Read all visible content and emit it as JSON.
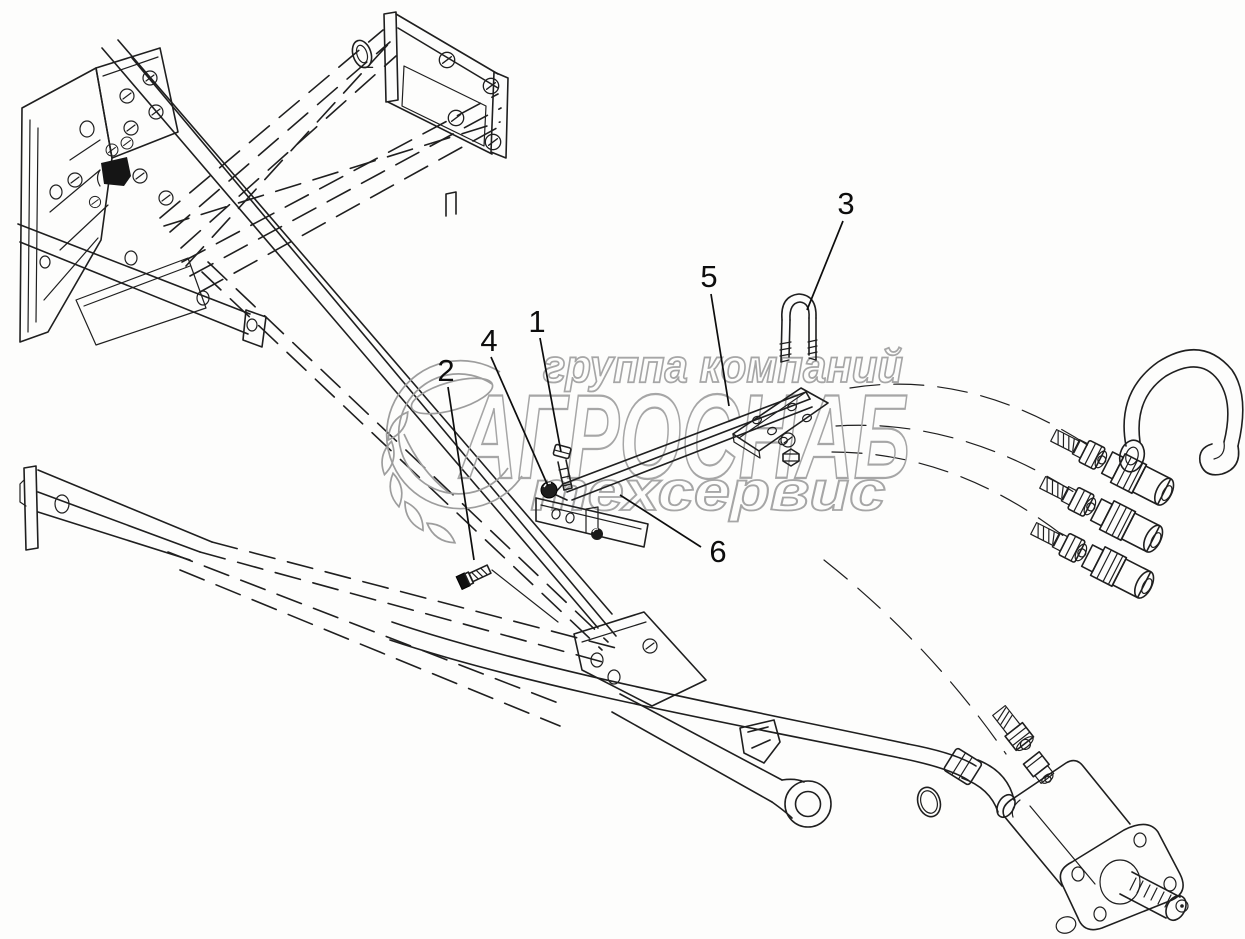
{
  "colors": {
    "ink": "#1f1f1f",
    "callout_ink": "#0d0d0d",
    "watermark": "#a6a6a6",
    "background": "#fdfdfc"
  },
  "watermark": {
    "line1": "группа компаний",
    "line2": "АГРОСНАБ",
    "line3": "техсервис"
  },
  "callouts": [
    {
      "label": "1",
      "x": 537,
      "y": 321,
      "leader": [
        540,
        338,
        561,
        452
      ]
    },
    {
      "label": "2",
      "x": 446,
      "y": 370,
      "leader": [
        448,
        387,
        474,
        560
      ]
    },
    {
      "label": "3",
      "x": 846,
      "y": 203,
      "leader": [
        843,
        221,
        807,
        310
      ]
    },
    {
      "label": "4",
      "x": 489,
      "y": 340,
      "leader": [
        491,
        357,
        548,
        486
      ]
    },
    {
      "label": "5",
      "x": 709,
      "y": 276,
      "leader": [
        711,
        294,
        729,
        406
      ]
    },
    {
      "label": "6",
      "x": 718,
      "y": 551,
      "leader": [
        701,
        547,
        620,
        495
      ]
    }
  ]
}
